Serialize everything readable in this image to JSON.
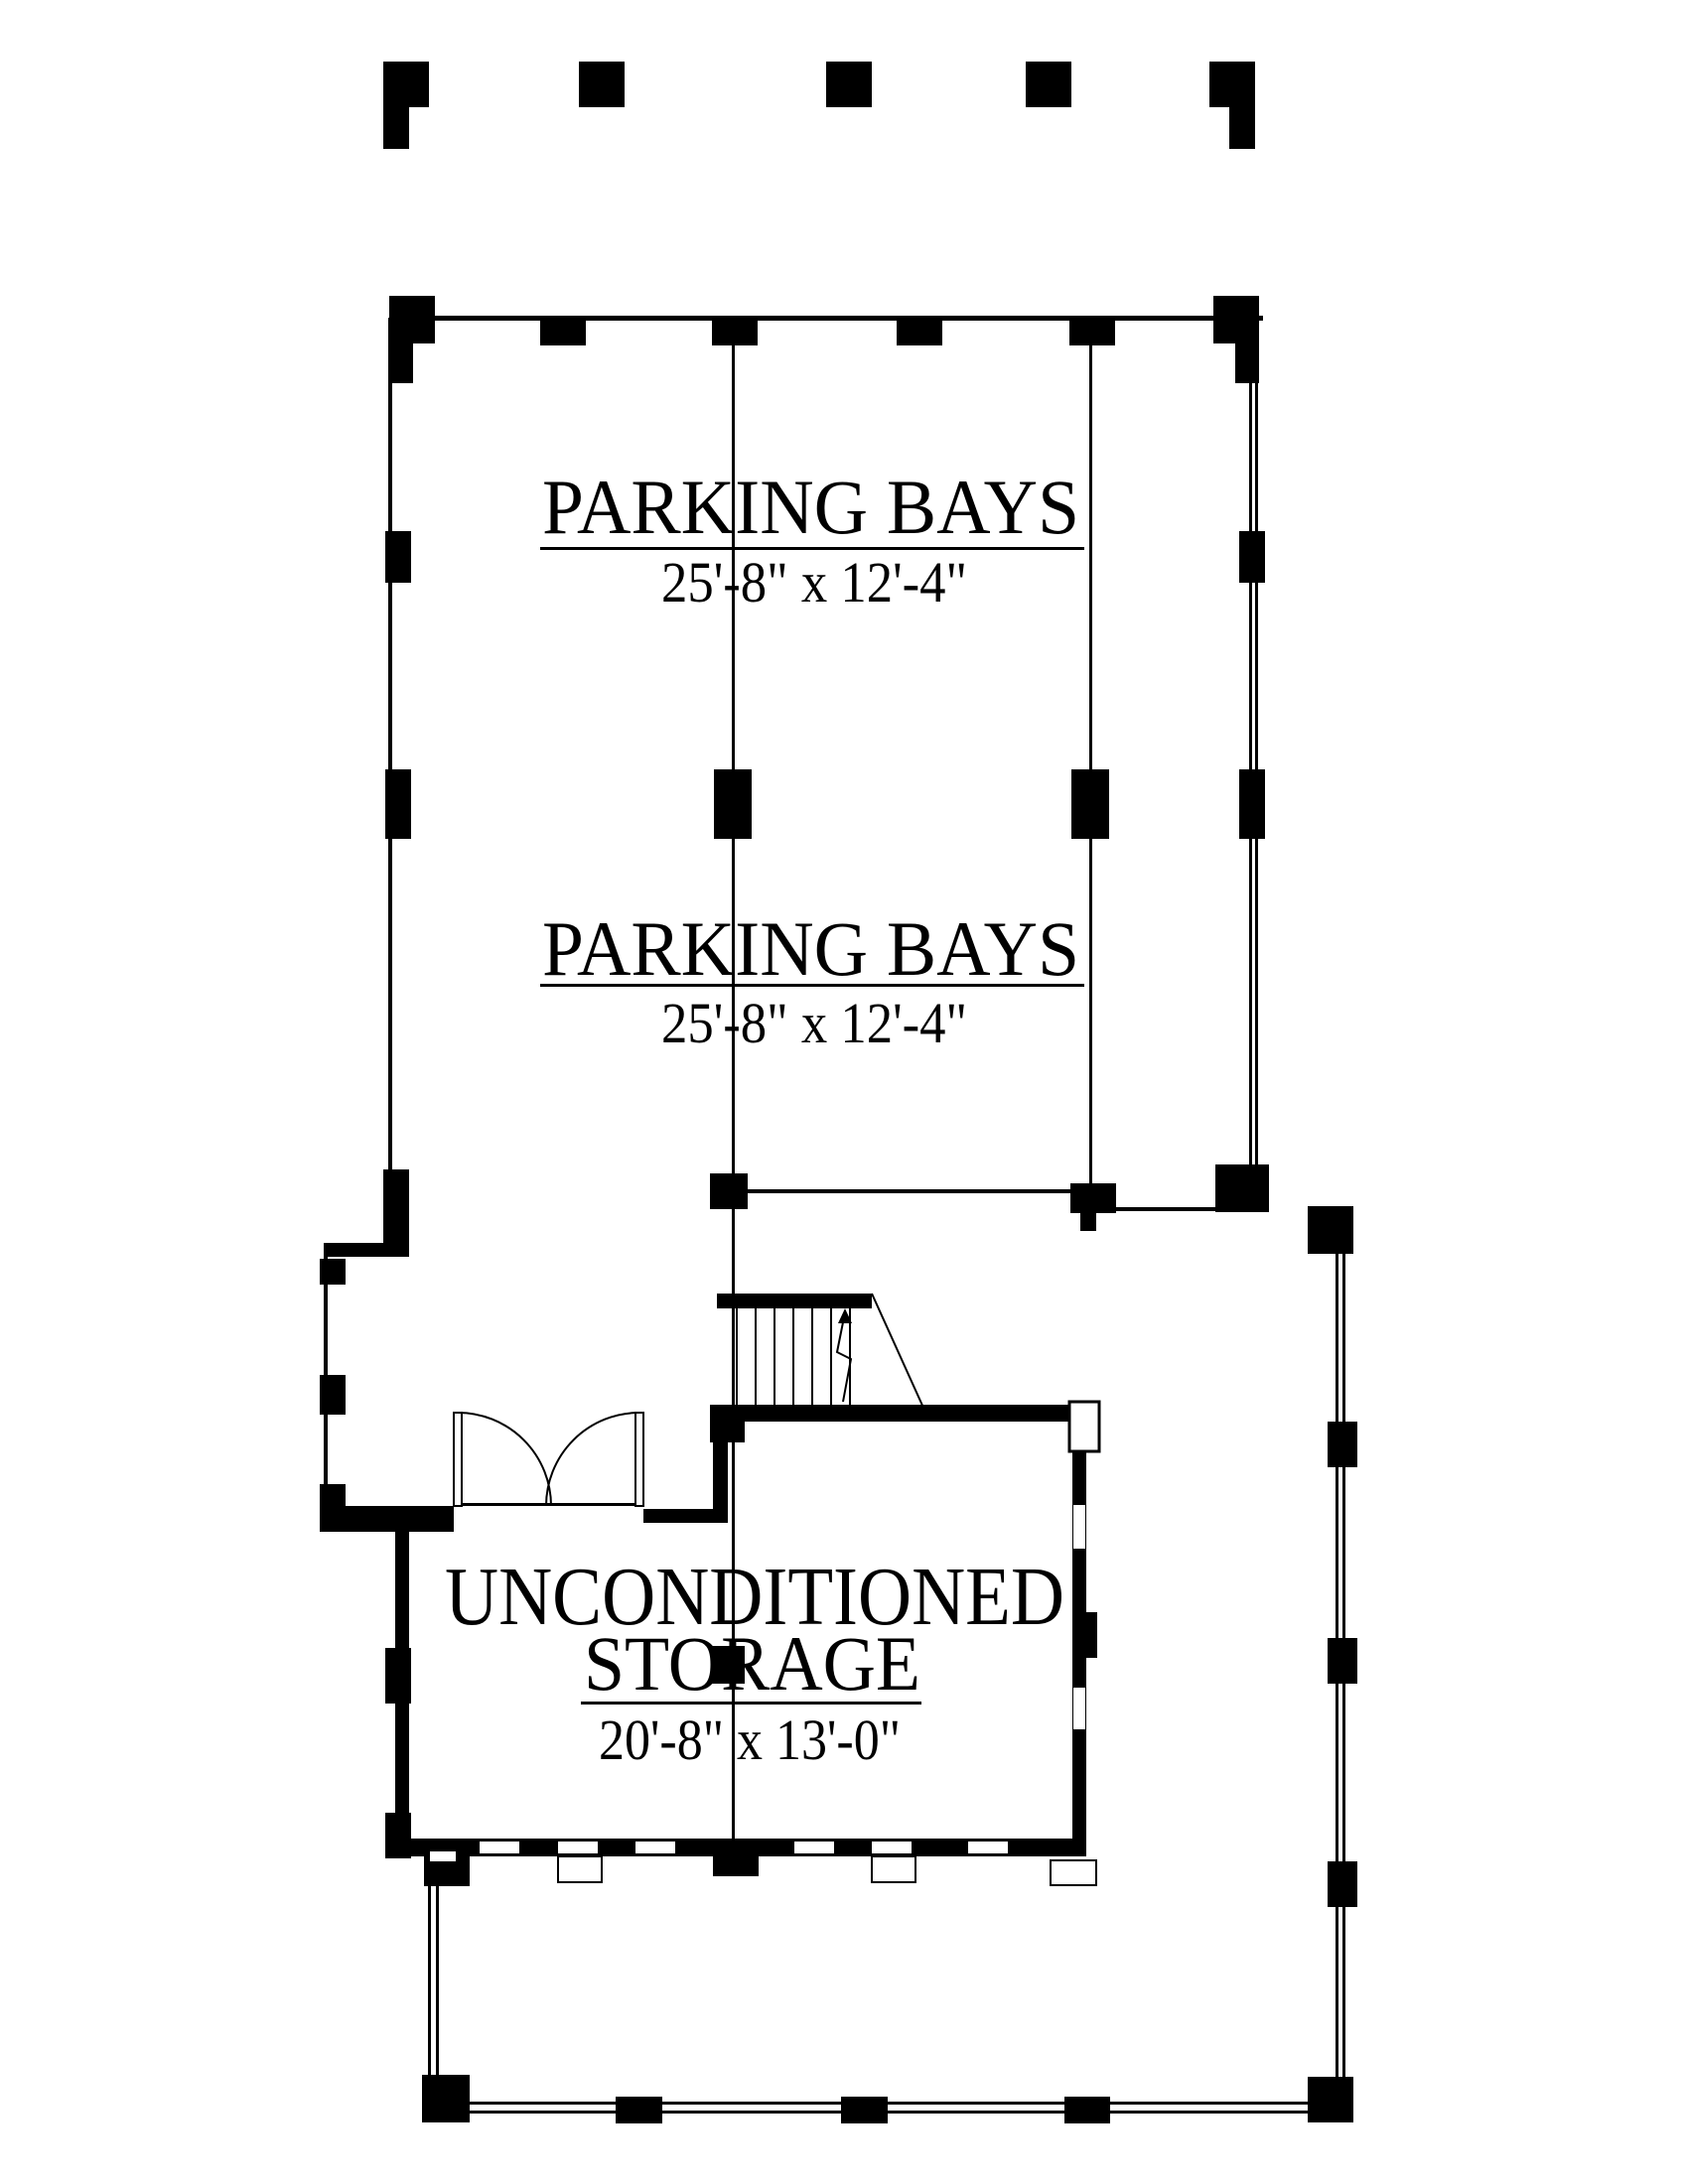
{
  "document": {
    "type": "architectural floor plan",
    "sheet": "garage / storage level"
  },
  "colors": {
    "ink": "#000000",
    "paper": "#ffffff"
  },
  "labels": [
    {
      "title": "PARKING BAYS",
      "dims": "25'-8\" x 12'-4\""
    },
    {
      "title": "PARKING BAYS",
      "dims": "25'-8\" x 12'-4\""
    },
    {
      "title_line1": "UNCONDITIONED",
      "title_line2": "STORAGE",
      "dims": "20'-8\" x 13'-0\""
    }
  ]
}
